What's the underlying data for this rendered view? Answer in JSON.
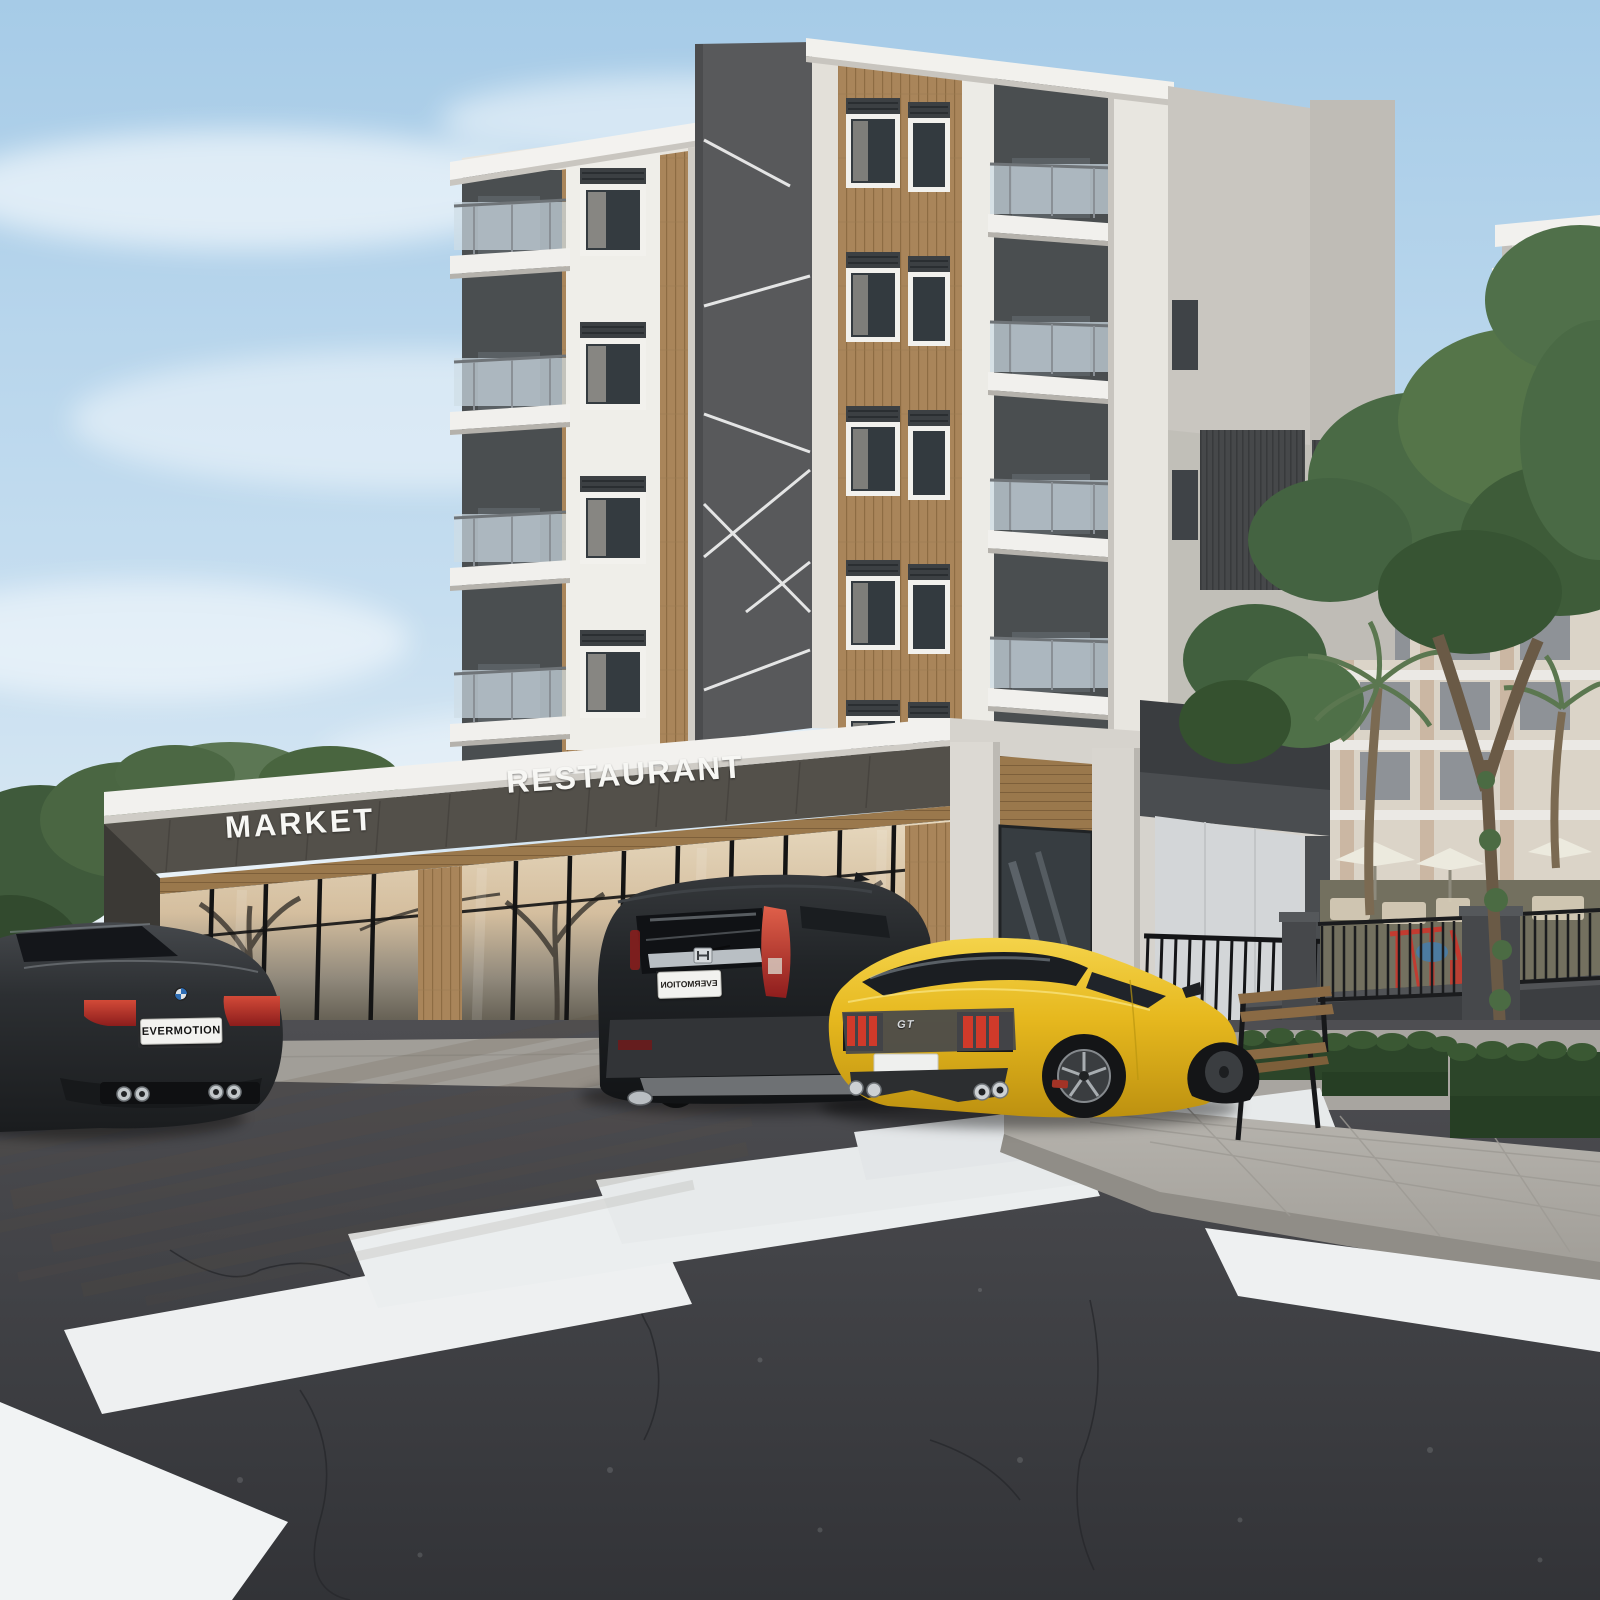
{
  "scene": {
    "description": "Photorealistic 3D exterior rendering of a modern apartment tower with a ground-floor retail podium, three parked cars and a zebra crosswalk",
    "sky": "light blue with wispy clouds"
  },
  "podium": {
    "market_sign": "MARKET",
    "restaurant_sign": "RESTAURANT"
  },
  "vehicles": {
    "bmw_coupe": {
      "color": "black",
      "license_plate": "EVERMOTION"
    },
    "honda_crv": {
      "color": "black",
      "license_plate_mirrored": "EVERMOTION"
    },
    "ford_mustang": {
      "color": "yellow",
      "trunk_badge": "GT"
    }
  },
  "palette": {
    "sky_top": "#a6cbe7",
    "sky_horizon": "#f0f5f8",
    "stucco": "#e8e5de",
    "wood_cladding": "#a9855a",
    "dark_core_panel": "#58595b",
    "podium_fascia": "#53504a",
    "asphalt": "#404145",
    "crosswalk_stripe": "#eef0f1",
    "mustang_yellow": "#e6b81e",
    "taillight_red": "#c0392b",
    "hedge_green": "#2c4529",
    "pavement": "#b3b0aa",
    "perimeter_wall": "#3c3e41",
    "playground_red": "#c23b30"
  }
}
